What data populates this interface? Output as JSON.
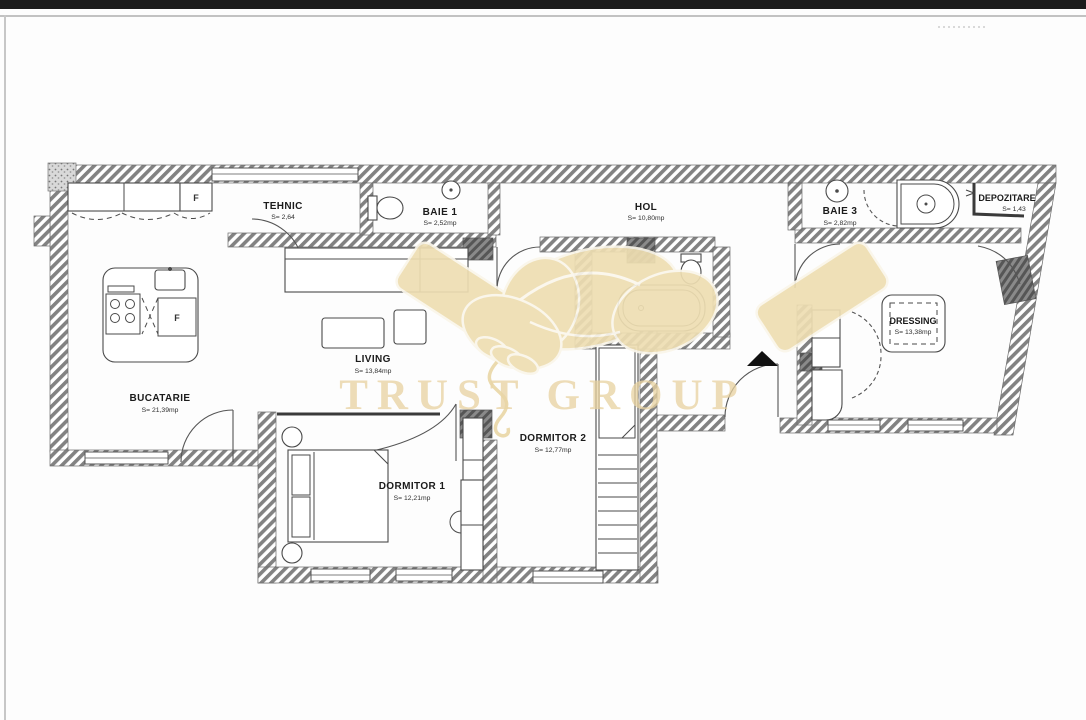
{
  "watermark": {
    "text": "TRUST GROUP",
    "color": "#e8d2a0"
  },
  "colors": {
    "top_bar": "#1c1c1c",
    "wall_hatch": "#828282",
    "drawing_line": "#4a4a4a",
    "watermark_beige": "#eedeb2"
  },
  "rooms": [
    {
      "name": "TEHNIC",
      "area": "S= 2,64"
    },
    {
      "name": "BAIE 1",
      "area": "S= 2,52mp"
    },
    {
      "name": "HOL",
      "area": "S= 10,80mp"
    },
    {
      "name": "BAIE 3",
      "area": "S= 2,82mp"
    },
    {
      "name": "DEPOZITARE",
      "area": "S= 1,43"
    },
    {
      "name": "BUCATARIE",
      "area": "S= 21,39mp"
    },
    {
      "name": "LIVING",
      "area": "S= 13,84mp"
    },
    {
      "name": "DRESSING",
      "area": "S= 13,38mp"
    },
    {
      "name": "DORMITOR 1",
      "area": "S= 12,21mp"
    },
    {
      "name": "DORMITOR 2",
      "area": "S= 12,77mp"
    }
  ],
  "annotations": {
    "fridge_label": "F",
    "island_appliance_label": "F"
  }
}
